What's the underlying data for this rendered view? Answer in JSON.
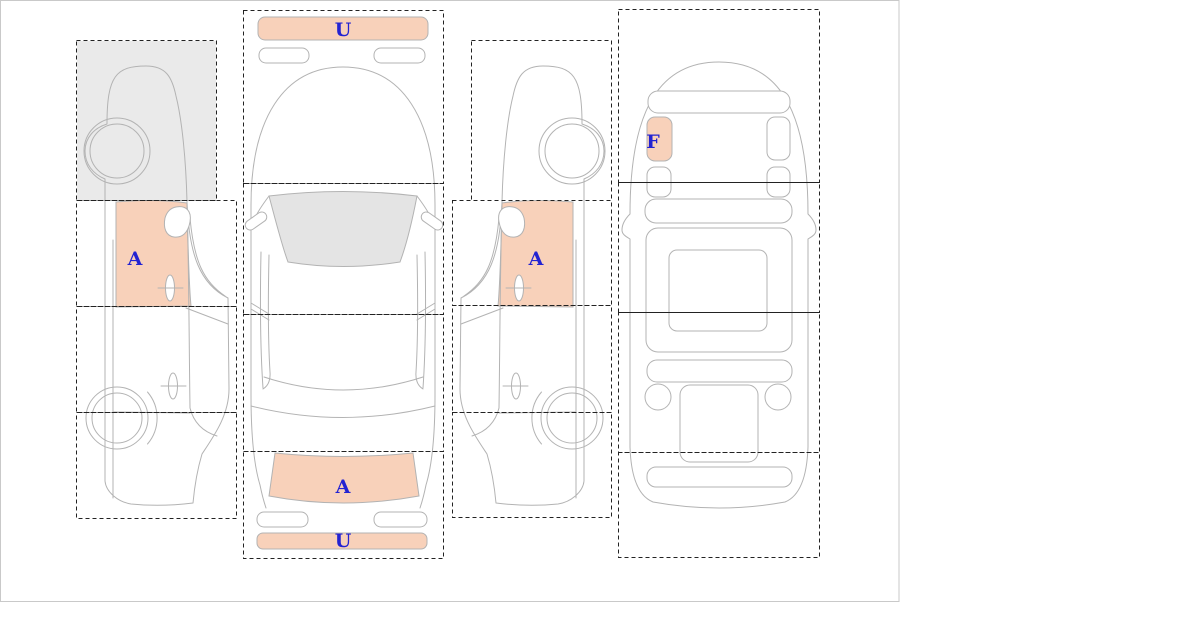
{
  "canvas": {
    "width": 1200,
    "height": 621,
    "panel_width": 900,
    "panel_height": 602,
    "border_color": "#c9c9c9",
    "background": "#ffffff"
  },
  "diagram": {
    "type": "vehicle-damage-selection-scheme",
    "markers": {
      "left_view_front_door": "A",
      "top_view_front_bumper": "U",
      "top_view_trunk": "A",
      "top_view_rear_bumper": "U",
      "right_view_front_door": "A",
      "interior_front_left_seat": "F"
    },
    "views": [
      {
        "id": "left-side-view",
        "zones": [
          {
            "index": 1,
            "section": "front",
            "state": "shaded"
          },
          {
            "index": 2,
            "section": "front-door",
            "state": "highlighted",
            "marker": "A"
          },
          {
            "index": 3,
            "section": "rear-door",
            "state": "clear"
          },
          {
            "index": 4,
            "section": "rear",
            "state": "clear"
          }
        ]
      },
      {
        "id": "top-view",
        "zones": [
          {
            "index": 1,
            "section": "front",
            "state": "clear",
            "highlighted_parts": [
              {
                "part": "front-bumper",
                "marker": "U"
              }
            ]
          },
          {
            "index": 2,
            "section": "windshield",
            "state": "clear"
          },
          {
            "index": 3,
            "section": "roof",
            "state": "clear"
          },
          {
            "index": 4,
            "section": "rear",
            "state": "clear",
            "highlighted_parts": [
              {
                "part": "trunk-lid",
                "marker": "A"
              },
              {
                "part": "rear-bumper",
                "marker": "U"
              }
            ]
          }
        ]
      },
      {
        "id": "right-side-view",
        "zones": [
          {
            "index": 1,
            "section": "front",
            "state": "clear"
          },
          {
            "index": 2,
            "section": "front-door",
            "state": "highlighted",
            "marker": "A"
          },
          {
            "index": 3,
            "section": "rear-door",
            "state": "clear"
          },
          {
            "index": 4,
            "section": "rear",
            "state": "clear"
          }
        ]
      },
      {
        "id": "interior-view",
        "zones": [
          {
            "index": 1,
            "section": "front-seats",
            "state": "clear",
            "highlighted_parts": [
              {
                "part": "front-left-seat",
                "marker": "F"
              }
            ]
          },
          {
            "index": 2,
            "section": "cabin",
            "state": "clear"
          },
          {
            "index": 3,
            "section": "rear-cabin",
            "state": "clear"
          },
          {
            "index": 4,
            "section": "trunk-area",
            "state": "clear"
          }
        ]
      }
    ],
    "colors": {
      "highlight": "#f8d1ba",
      "shaded_zone": "#eaeaea",
      "glass": "#e4e4e4",
      "car_outline": "#b3b3b3",
      "zone_border": "#222222",
      "marker_text": "#2323d2"
    }
  }
}
